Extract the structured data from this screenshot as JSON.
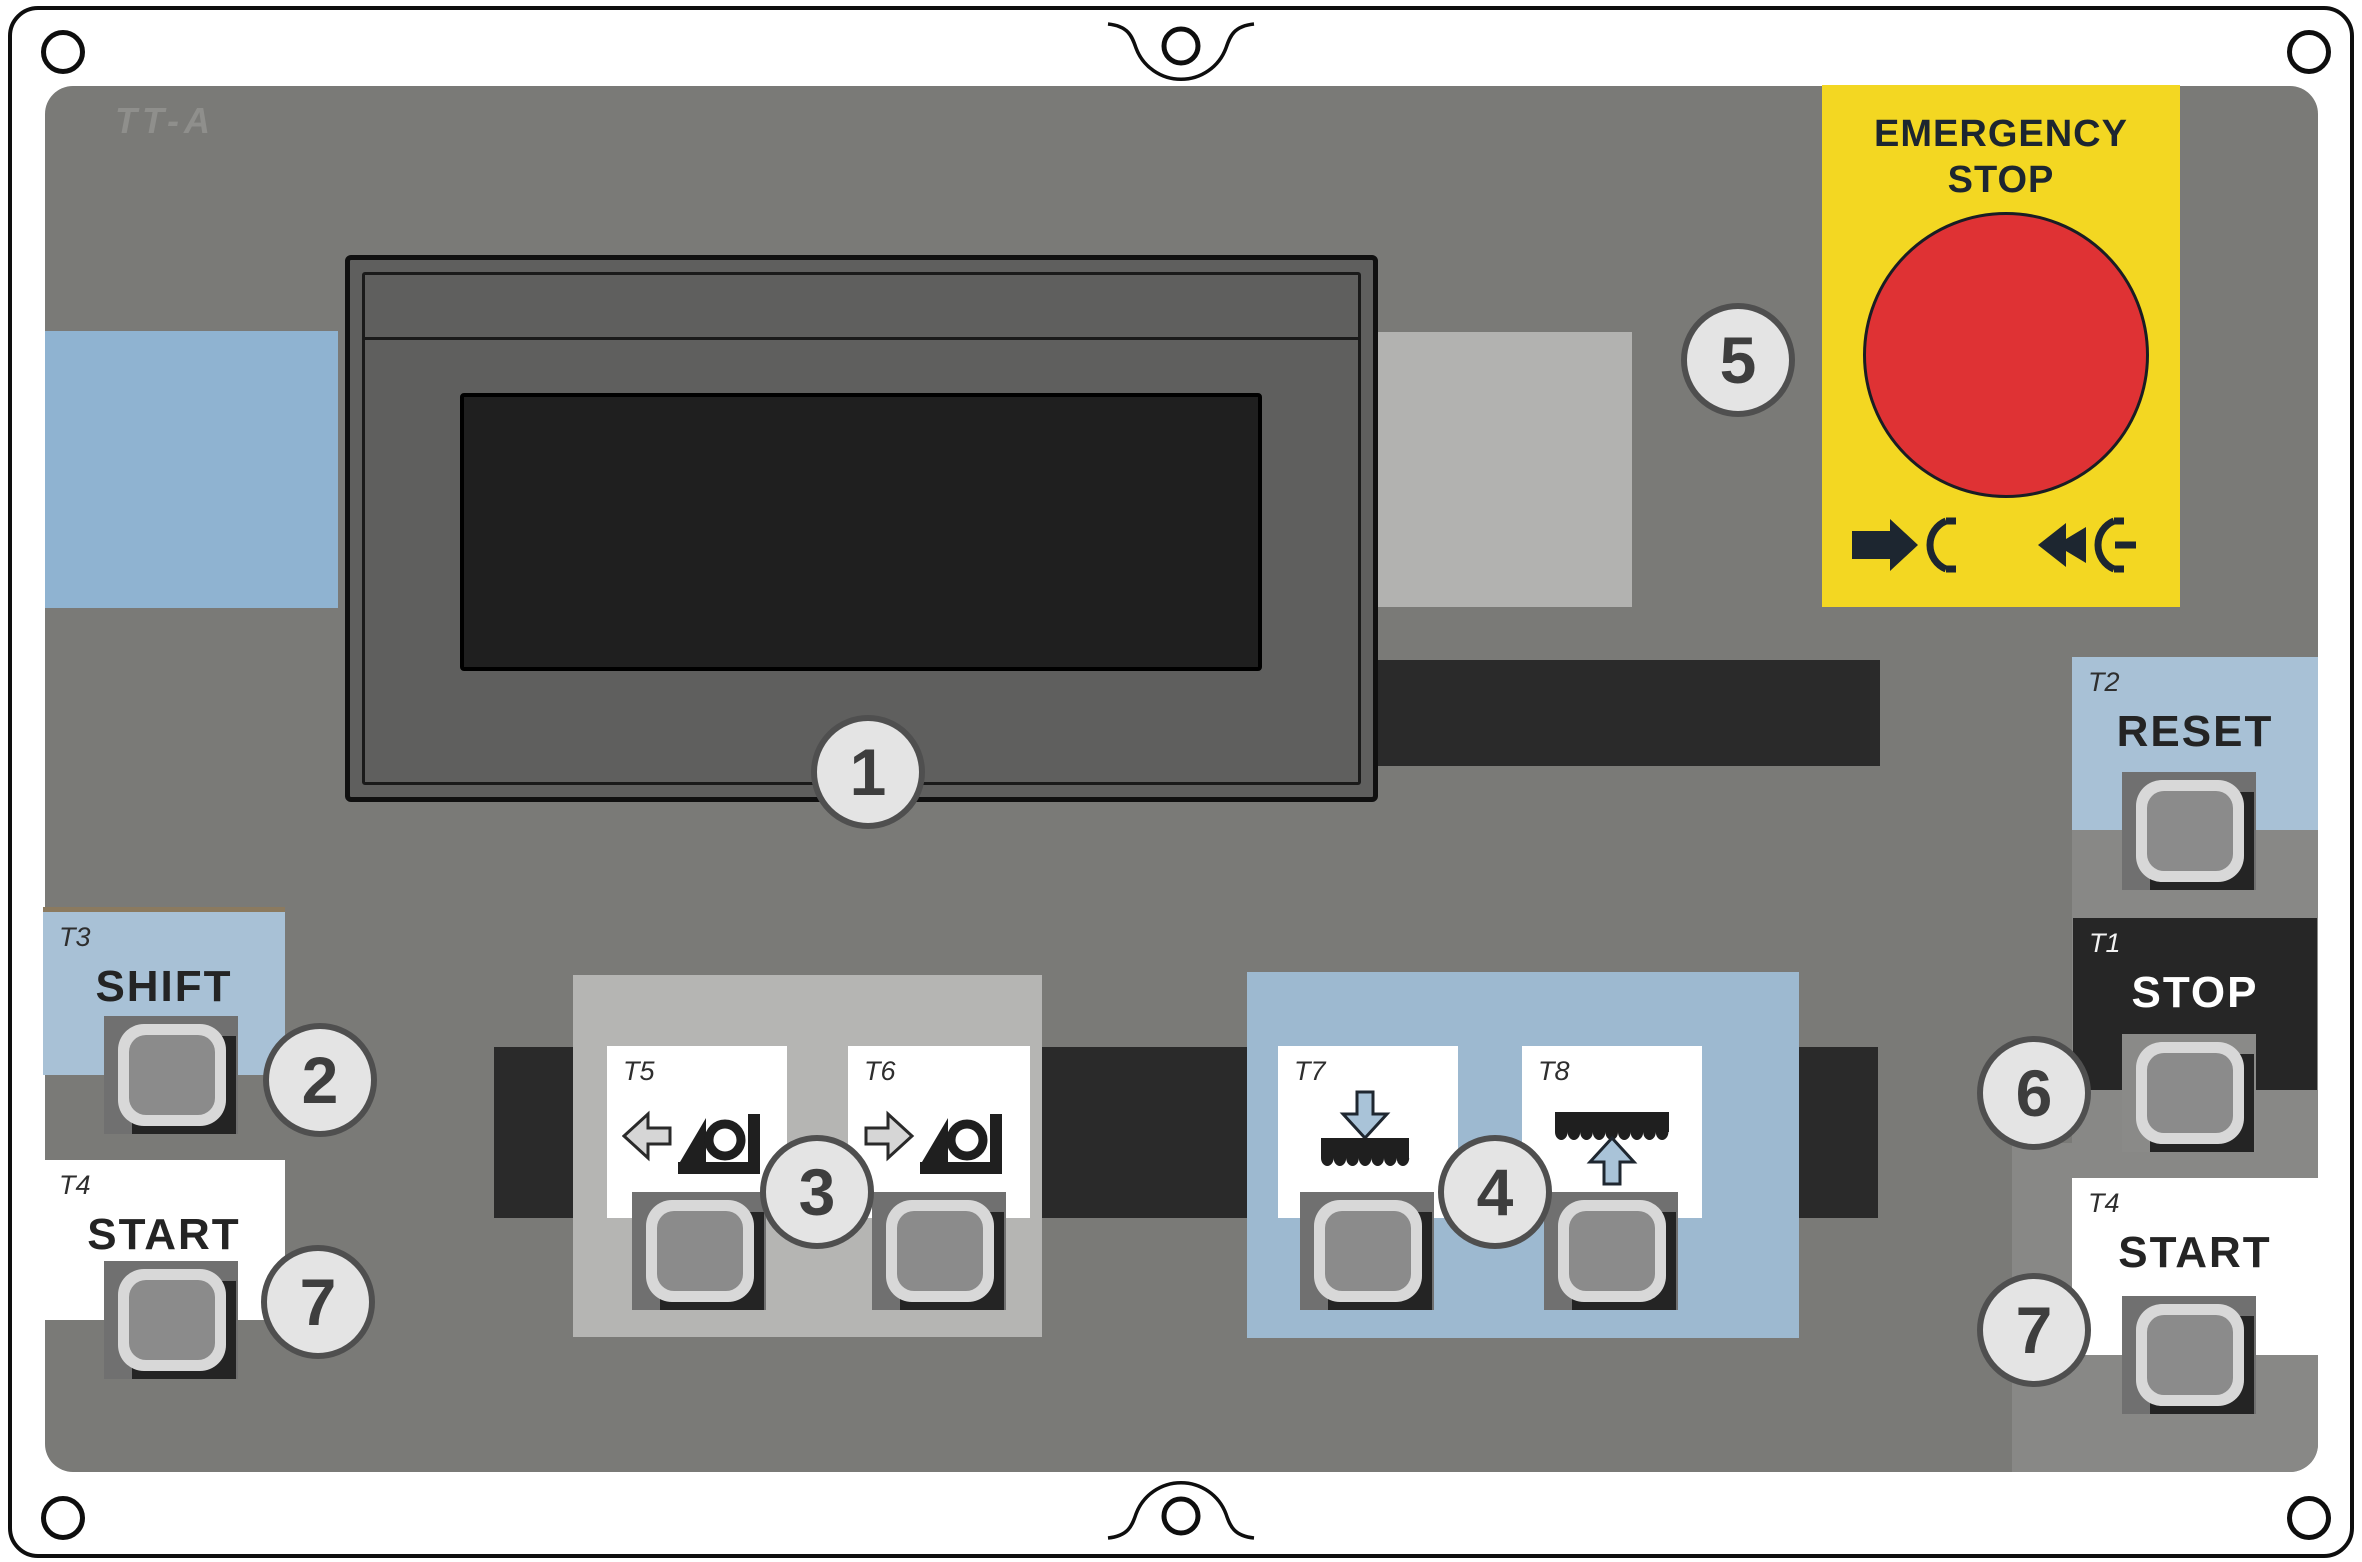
{
  "brand": "TT-A",
  "emergency": {
    "line1": "EMERGENCY",
    "line2": "STOP"
  },
  "keys": {
    "reset": {
      "tag": "T2",
      "label": "RESET"
    },
    "stop": {
      "tag": "T1",
      "label": "STOP"
    },
    "start_right": {
      "tag": "T4",
      "label": "START"
    },
    "shift": {
      "tag": "T3",
      "label": "SHIFT"
    },
    "start_left": {
      "tag": "T4",
      "label": "START"
    },
    "t5": {
      "tag": "T5"
    },
    "t6": {
      "tag": "T6"
    },
    "t7": {
      "tag": "T7"
    },
    "t8": {
      "tag": "T8"
    }
  },
  "callouts": {
    "display": "1",
    "shift": "2",
    "group_left": "3",
    "group_right": "4",
    "estop": "5",
    "stop": "6",
    "start_left": "7",
    "start_right": "7"
  },
  "icons": [
    "mounting-hole-icon",
    "mounting-notch-icon",
    "press-to-stop-icon",
    "pull-to-release-icon",
    "move-left-icon",
    "move-right-icon",
    "blade-down-icon",
    "blade-up-icon"
  ],
  "colors": {
    "panel": "#7a7a77",
    "emergency_yellow": "#f3d722",
    "emergency_red": "#df3234",
    "blue_strip": "#8fb3d1",
    "blue_key_box": "#a8c1d6",
    "blue_group_box": "#9db9d0",
    "gray_group_box": "#b5b5b3",
    "dark_bar": "#2a2a2a",
    "button_ring": "#d8d8d8",
    "callout_fill": "#e4e4e4"
  }
}
